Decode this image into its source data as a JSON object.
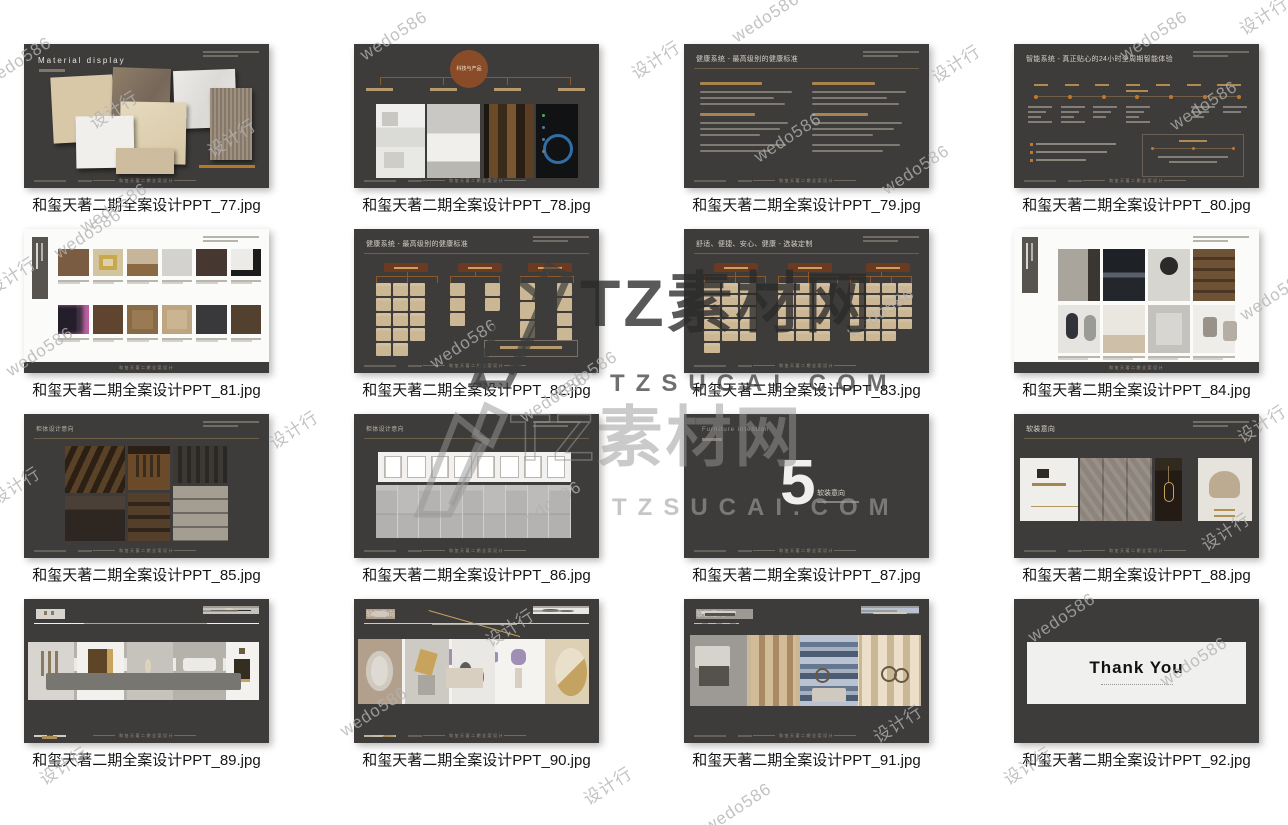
{
  "colors": {
    "slide_bg": "#3e3c3a",
    "accent_orange": "#b5772a",
    "beige_box": "#ccb795",
    "bronze_rule": "#6e5f49",
    "caption_text": "#151515"
  },
  "footer_text": "和玺天著二期全案设计",
  "watermarks": {
    "brand1": {
      "title": "TZ素材网",
      "url": "TZSUCAI.COM"
    },
    "brand2": {
      "prefix": "TZ",
      "title": "素材网",
      "url": "TZSUCAI.COM"
    },
    "small": [
      {
        "text": "wedo586",
        "x": 728,
        "y": 8
      },
      {
        "text": "设计行",
        "x": 1236,
        "y": 2
      },
      {
        "text": "wedo586",
        "x": 1116,
        "y": 26
      },
      {
        "text": "wedo586",
        "x": 356,
        "y": 26
      },
      {
        "text": "设计行",
        "x": 628,
        "y": 46
      },
      {
        "text": "设计行",
        "x": 928,
        "y": 50
      },
      {
        "text": "设计行",
        "x": 86,
        "y": 96
      },
      {
        "text": "设计行",
        "x": 204,
        "y": 124
      },
      {
        "text": "wedo586",
        "x": 750,
        "y": 128
      },
      {
        "text": "wedo586",
        "x": 878,
        "y": 160
      },
      {
        "text": "wedo586",
        "x": 1166,
        "y": 96
      },
      {
        "text": "wedo586",
        "x": -20,
        "y": 52
      },
      {
        "text": "wedo586",
        "x": 76,
        "y": 198
      },
      {
        "text": "wedo586",
        "x": 50,
        "y": 224
      },
      {
        "text": "设计行",
        "x": -16,
        "y": 262
      },
      {
        "text": "wedo586",
        "x": 2,
        "y": 342
      },
      {
        "text": "wedo586",
        "x": 426,
        "y": 334
      },
      {
        "text": "wedo586",
        "x": 546,
        "y": 366
      },
      {
        "text": "wedo586",
        "x": 516,
        "y": 388
      },
      {
        "text": "wedo586",
        "x": 843,
        "y": 303
      },
      {
        "text": "wedo586",
        "x": 1236,
        "y": 286
      },
      {
        "text": "设计行",
        "x": 266,
        "y": 416
      },
      {
        "text": "设计行",
        "x": -12,
        "y": 472
      },
      {
        "text": "wedo586",
        "x": 510,
        "y": 496
      },
      {
        "text": "设计行",
        "x": 1198,
        "y": 518
      },
      {
        "text": "设计行",
        "x": 1234,
        "y": 410
      },
      {
        "text": "设计行",
        "x": 482,
        "y": 614
      },
      {
        "text": "wedo586",
        "x": 336,
        "y": 702
      },
      {
        "text": "设计行",
        "x": 870,
        "y": 710
      },
      {
        "text": "设计行",
        "x": 36,
        "y": 752
      },
      {
        "text": "wedo586",
        "x": 1024,
        "y": 608
      },
      {
        "text": "wedo586",
        "x": 1156,
        "y": 652
      },
      {
        "text": "设计行",
        "x": 1000,
        "y": 752
      },
      {
        "text": "设计行",
        "x": 580,
        "y": 772
      },
      {
        "text": "wedo586",
        "x": 700,
        "y": 798
      }
    ]
  },
  "slides": [
    {
      "caption": "和玺天著二期全案设计PPT_77.jpg",
      "title": "Material display"
    },
    {
      "caption": "和玺天著二期全案设计PPT_78.jpg",
      "badge": "科技与产品"
    },
    {
      "caption": "和玺天著二期全案设计PPT_79.jpg",
      "title": "健康系统 - 最高级别的健康标准"
    },
    {
      "caption": "和玺天著二期全案设计PPT_80.jpg",
      "title": "智能系统 - 真正贴心的24小时全周期智能体验"
    },
    {
      "caption": "和玺天著二期全案设计PPT_81.jpg"
    },
    {
      "caption": "和玺天著二期全案设计PPT_82.jpg",
      "title": "健康系统 - 最高级别的健康标准"
    },
    {
      "caption": "和玺天著二期全案设计PPT_83.jpg",
      "title": "舒适、便捷、安心、健康 - 选装定制"
    },
    {
      "caption": "和玺天著二期全案设计PPT_84.jpg"
    },
    {
      "caption": "和玺天著二期全案设计PPT_85.jpg",
      "title": "柜体设计意向"
    },
    {
      "caption": "和玺天著二期全案设计PPT_86.jpg",
      "title": "柜体设计意向"
    },
    {
      "caption": "和玺天著二期全案设计PPT_87.jpg",
      "eyebrow": "Furniture intention",
      "number": "5",
      "label": "软装意向"
    },
    {
      "caption": "和玺天著二期全案设计PPT_88.jpg",
      "title": "软装意向"
    },
    {
      "caption": "和玺天著二期全案设计PPT_89.jpg",
      "title": "软装意向"
    },
    {
      "caption": "和玺天著二期全案设计PPT_90.jpg",
      "title": "软装意向"
    },
    {
      "caption": "和玺天著二期全案设计PPT_91.jpg",
      "title": "软装意向"
    },
    {
      "caption": "和玺天著二期全案设计PPT_92.jpg",
      "message": "Thank You"
    }
  ]
}
